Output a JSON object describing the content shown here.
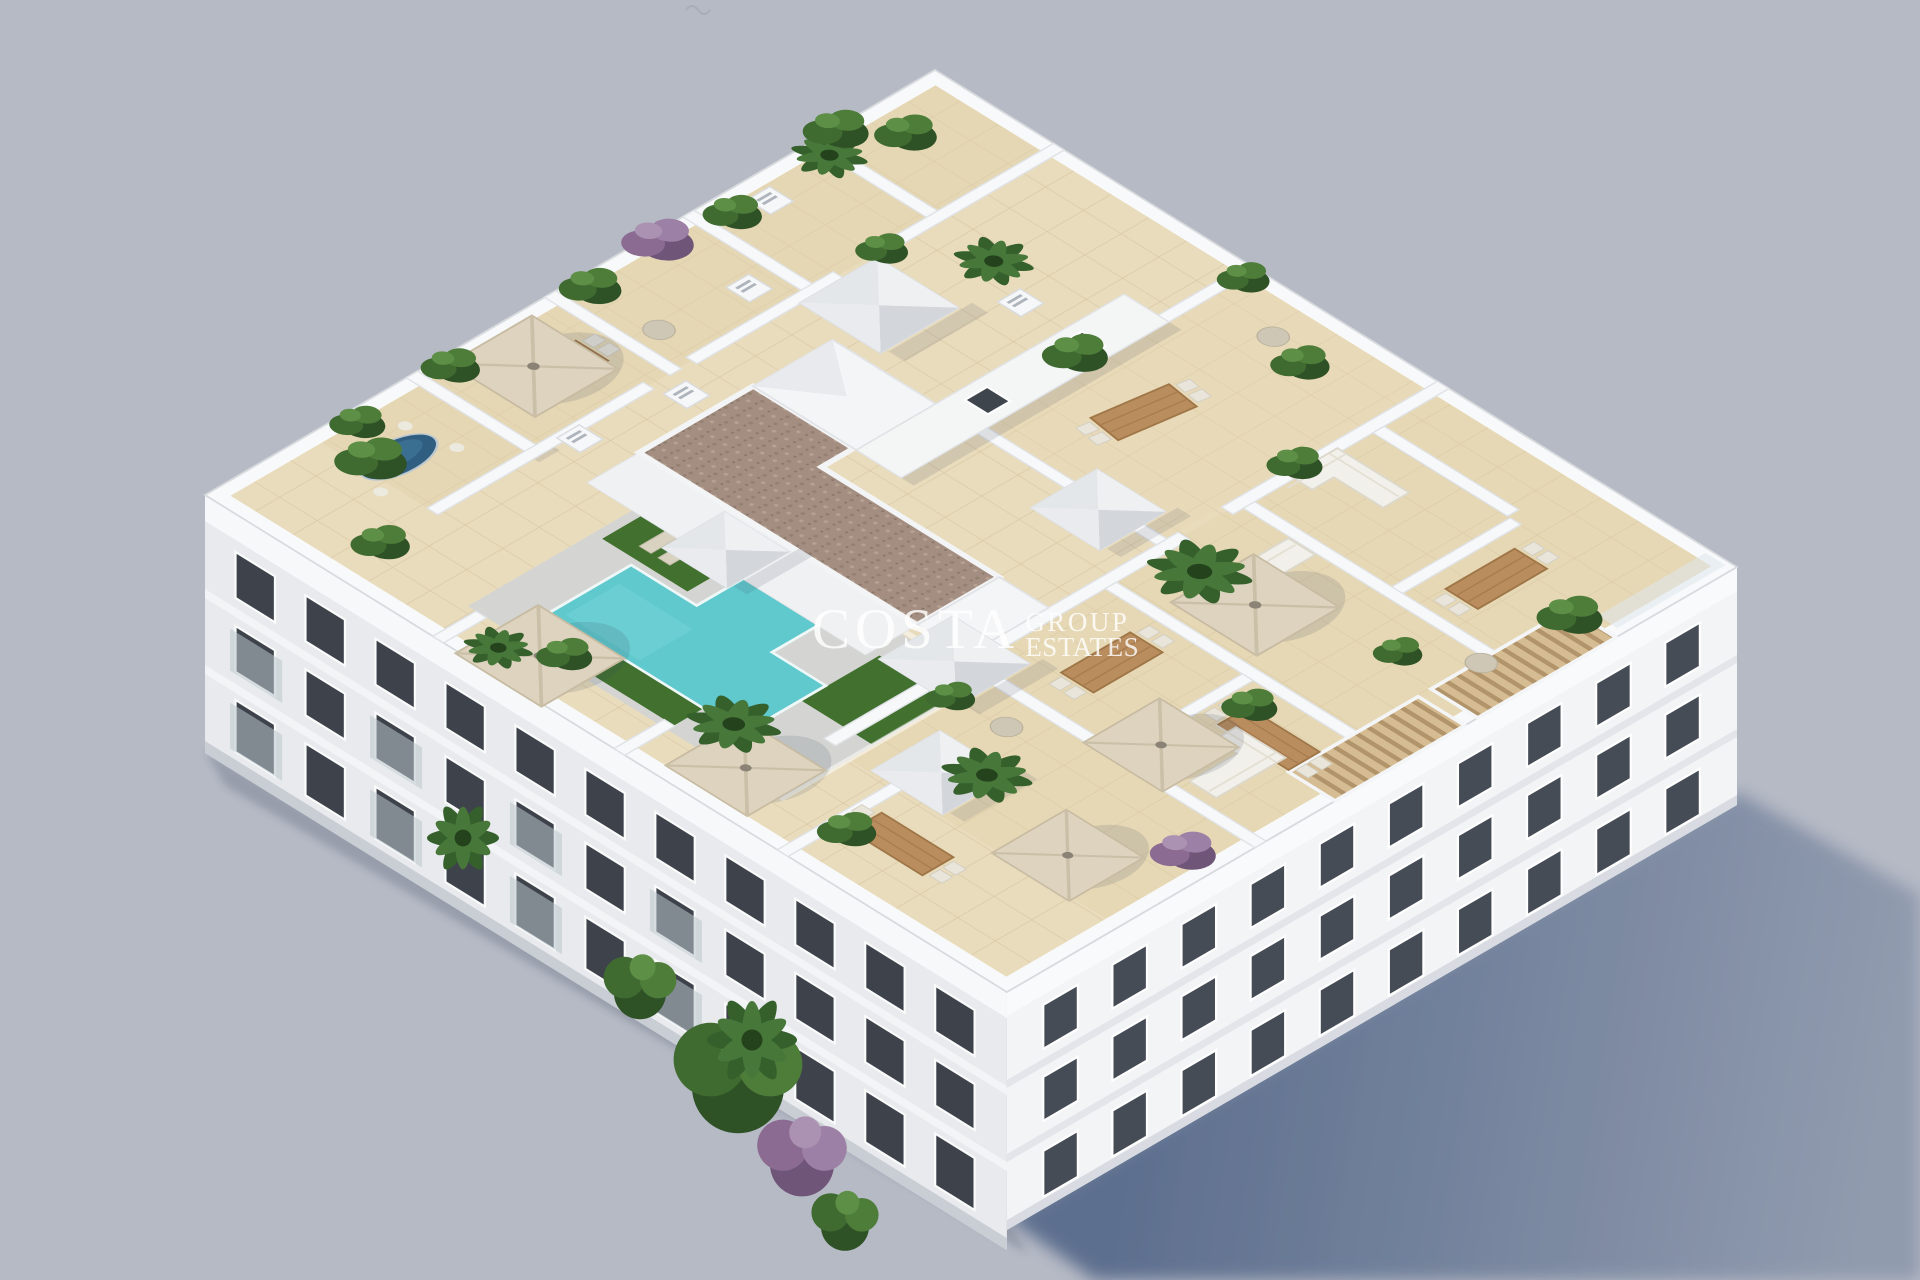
{
  "scene": {
    "type": "3d-architectural-render",
    "description": "Aerial axonometric render of a white apartment block: rooftop solarium with communal pool, artificial grass, private terraces divided by white parapets, parasols, dining sets, potted plants, slatted pergola and skylights; sun shadow cast to the lower right",
    "background_color": "#b6bac5",
    "cast_shadow_color": "#5c6f8d",
    "building": {
      "wall_color": "#f3f4f6",
      "shaded_wall_color": "#e8eaed",
      "window_color": "#3d424b",
      "parapet_color": "#f8f9fa"
    },
    "rooftop": {
      "tile_color": "#e9dcbd",
      "tile_joint_color": "#d8c6a2",
      "deck_color": "#d4d5d2",
      "pool_color": "#60c9cd",
      "grass_color": "#41702f",
      "gravel_roof_color": "#a48e81",
      "pergola_slat_color": "#d6bc92",
      "umbrella_color": "#ddd3bf",
      "wood_table_color": "#b98d5e",
      "blue_table_color": "#2f5e80"
    },
    "vegetation": {
      "palm_green": "#35602c",
      "bush_dark_green": "#2e5226",
      "bush_light_green": "#5d8f46",
      "purple_bush": "#8b6b92"
    },
    "features": [
      "rooftop pool",
      "sun terraces",
      "parasols",
      "dining sets",
      "planted pots",
      "slatted pergola",
      "skylights",
      "sun loungers"
    ]
  },
  "watermark": {
    "brand": "COSTA",
    "line1": "GROUP",
    "line2": "ESTATES",
    "color": "#ffffff"
  }
}
